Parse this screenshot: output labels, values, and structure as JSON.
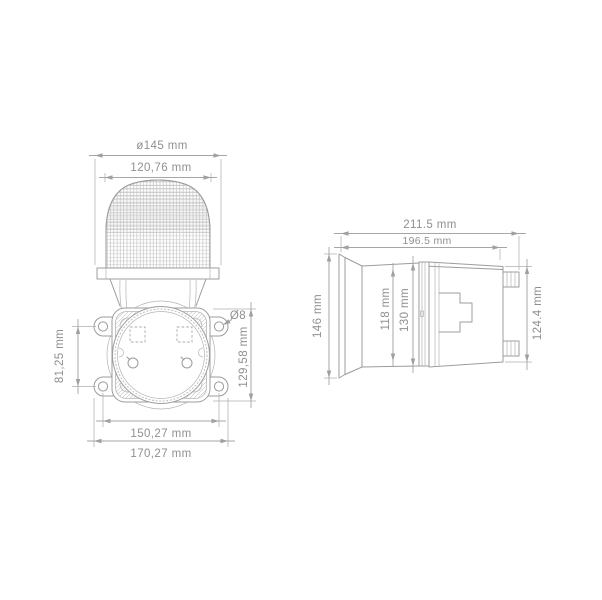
{
  "drawing": {
    "background_color": "#ffffff",
    "line_color": "#9c9c9c",
    "dimension_color": "#a6a6a6",
    "text_color": "#8f8f8f",
    "front_view": {
      "labels": {
        "flange_diameter": "ø145 mm",
        "lens_width": "120,76 mm",
        "hole_spacing_vertical": "81,25 mm",
        "plate_height": "129,58 mm",
        "hole_diameter": "Ø8",
        "hole_spacing_horizontal": "150,27 mm",
        "overall_width": "170,27 mm"
      }
    },
    "side_view": {
      "labels": {
        "overall_length": "211.5 mm",
        "body_length": "196.5 mm",
        "front_diameter": "146 mm",
        "lens_height": "118 mm",
        "plate_height": "130 mm",
        "housing_height": "124.4 mm"
      }
    }
  }
}
